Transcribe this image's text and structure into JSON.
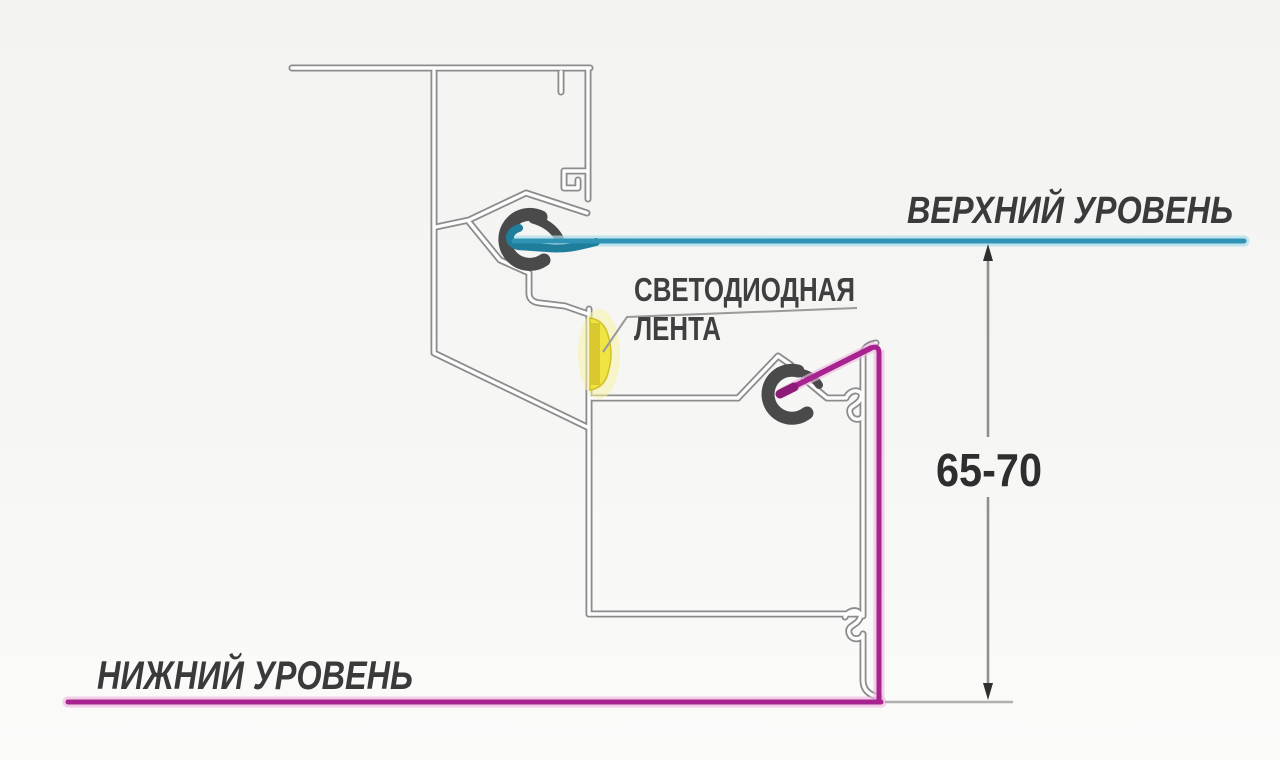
{
  "diagram": {
    "upper_level_label": "ВЕРХНИЙ УРОВЕНЬ",
    "lower_level_label": "НИЖНИЙ УРОВЕНЬ",
    "led_label_line1": "СВЕТОДИОДНАЯ",
    "led_label_line2": "ЛЕНТА",
    "dimension_label": "65-70"
  },
  "colors": {
    "upper_level_line": "#2e93b4",
    "upper_level_glow": "#a9dde9",
    "lower_level_line": "#a82390",
    "lower_level_glow": "#edb9df",
    "led_yellow": "#f0e344",
    "profile_gray": "#8c8c8c",
    "clip_dark": "#4a4a4a",
    "text": "#3a3a3a"
  }
}
